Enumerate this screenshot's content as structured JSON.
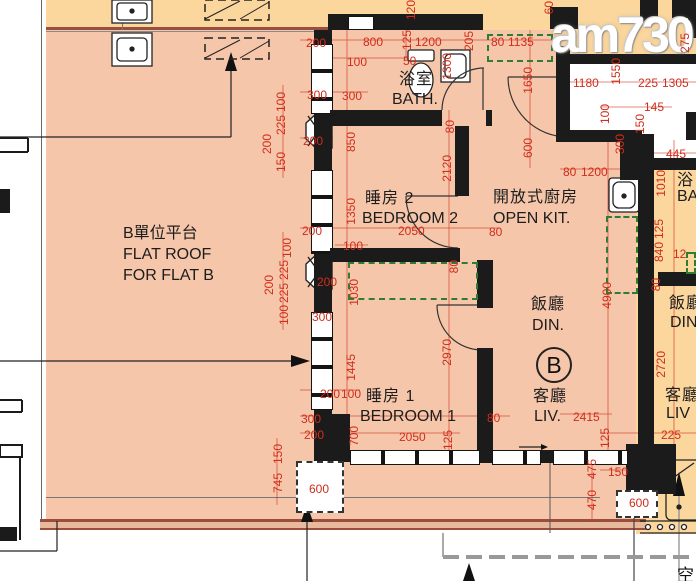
{
  "watermark": {
    "text": "am730"
  },
  "unit_badge": "B",
  "corner_label": "空",
  "colors": {
    "floor_pink": "#f6c6aa",
    "floor_orange": "#fbd79e",
    "dimension_red": "#d02d1c",
    "wall_black": "#1b1b1b",
    "cabinet_green": "#2e7d32",
    "parapet_maroon": "#9a4f3e"
  },
  "rooms": {
    "bath": {
      "zh": "浴室",
      "en": "BATH."
    },
    "bedroom2": {
      "zh": "睡房 2",
      "en": "BEDROOM 2"
    },
    "open_kitchen": {
      "zh": "開放式廚房",
      "en": "OPEN KIT."
    },
    "dining": {
      "zh": "飯廳",
      "en": "DIN."
    },
    "living": {
      "zh": "客廳",
      "en": "LIV."
    },
    "bedroom1": {
      "zh": "睡房 1",
      "en": "BEDROOM 1"
    },
    "flat_roof": {
      "zh": "B單位平台",
      "en_line1": "FLAT ROOF",
      "en_line2": "FOR FLAT B"
    }
  },
  "adjacent_unit": {
    "bath": {
      "zh": "浴",
      "en": "BA"
    },
    "dining": {
      "zh": "飯廳",
      "en": "DIN"
    },
    "living": {
      "zh": "客廳",
      "en": "LIV"
    }
  },
  "dimensions": [
    {
      "t": "200",
      "x": 306,
      "y": 37
    },
    {
      "t": "300",
      "x": 307,
      "y": 89
    },
    {
      "t": "100",
      "x": 275,
      "y": 92,
      "v": 1
    },
    {
      "t": "225",
      "x": 275,
      "y": 115,
      "v": 1
    },
    {
      "t": "200",
      "x": 261,
      "y": 134,
      "v": 1
    },
    {
      "t": "200",
      "x": 303,
      "y": 135
    },
    {
      "t": "150",
      "x": 275,
      "y": 152,
      "v": 1
    },
    {
      "t": "200",
      "x": 302,
      "y": 225
    },
    {
      "t": "100",
      "x": 281,
      "y": 238,
      "v": 1
    },
    {
      "t": "225",
      "x": 278,
      "y": 260,
      "v": 1
    },
    {
      "t": "200",
      "x": 263,
      "y": 275,
      "v": 1
    },
    {
      "t": "225",
      "x": 278,
      "y": 283,
      "v": 1
    },
    {
      "t": "100",
      "x": 278,
      "y": 305,
      "v": 1
    },
    {
      "t": "200",
      "x": 317,
      "y": 276
    },
    {
      "t": "300",
      "x": 312,
      "y": 311
    },
    {
      "t": "150",
      "x": 272,
      "y": 444,
      "v": 1
    },
    {
      "t": "745",
      "x": 272,
      "y": 473,
      "v": 1
    },
    {
      "t": "300",
      "x": 301,
      "y": 413
    },
    {
      "t": "200",
      "x": 304,
      "y": 429
    },
    {
      "t": "200",
      "x": 320,
      "y": 388
    },
    {
      "t": "100",
      "x": 341,
      "y": 388
    },
    {
      "t": "120",
      "x": 405,
      "y": 0,
      "v": 1
    },
    {
      "t": "800",
      "x": 363,
      "y": 36
    },
    {
      "t": "125",
      "x": 401,
      "y": 30,
      "v": 1
    },
    {
      "t": "1200",
      "x": 415,
      "y": 36
    },
    {
      "t": "205",
      "x": 463,
      "y": 31,
      "v": 1
    },
    {
      "t": "80",
      "x": 491,
      "y": 36
    },
    {
      "t": "1135",
      "x": 508,
      "y": 36
    },
    {
      "t": "100",
      "x": 347,
      "y": 56
    },
    {
      "t": "50",
      "x": 403,
      "y": 55
    },
    {
      "t": "300",
      "x": 342,
      "y": 90
    },
    {
      "t": "1300",
      "x": 441,
      "y": 53,
      "v": 1
    },
    {
      "t": "60",
      "x": 543,
      "y": 1,
      "v": 1
    },
    {
      "t": "1650",
      "x": 522,
      "y": 67,
      "v": 1
    },
    {
      "t": "600",
      "x": 522,
      "y": 138,
      "v": 1
    },
    {
      "t": "275",
      "x": 679,
      "y": 33,
      "v": 1
    },
    {
      "t": "1180",
      "x": 573,
      "y": 77
    },
    {
      "t": "1550",
      "x": 610,
      "y": 58,
      "v": 1
    },
    {
      "t": "225",
      "x": 638,
      "y": 77
    },
    {
      "t": "1305",
      "x": 662,
      "y": 77
    },
    {
      "t": "100",
      "x": 599,
      "y": 104,
      "v": 1
    },
    {
      "t": "145",
      "x": 644,
      "y": 101
    },
    {
      "t": "150",
      "x": 634,
      "y": 114,
      "v": 1
    },
    {
      "t": "300",
      "x": 614,
      "y": 134,
      "v": 1
    },
    {
      "t": "445",
      "x": 666,
      "y": 148
    },
    {
      "t": "1010",
      "x": 655,
      "y": 170,
      "v": 1
    },
    {
      "t": "80",
      "x": 563,
      "y": 166
    },
    {
      "t": "1200",
      "x": 581,
      "y": 166
    },
    {
      "t": "850",
      "x": 345,
      "y": 132,
      "v": 1
    },
    {
      "t": "80",
      "x": 444,
      "y": 120,
      "v": 1
    },
    {
      "t": "2120",
      "x": 441,
      "y": 155,
      "v": 1
    },
    {
      "t": "1350",
      "x": 345,
      "y": 198,
      "v": 1
    },
    {
      "t": "2050",
      "x": 398,
      "y": 225
    },
    {
      "t": "80",
      "x": 489,
      "y": 226
    },
    {
      "t": "100",
      "x": 343,
      "y": 240
    },
    {
      "t": "80",
      "x": 448,
      "y": 260,
      "v": 1
    },
    {
      "t": "1030",
      "x": 348,
      "y": 279,
      "v": 1
    },
    {
      "t": "4900",
      "x": 601,
      "y": 282,
      "v": 1
    },
    {
      "t": "125",
      "x": 653,
      "y": 219,
      "v": 1
    },
    {
      "t": "840",
      "x": 653,
      "y": 242,
      "v": 1
    },
    {
      "t": "80",
      "x": 650,
      "y": 278,
      "v": 1
    },
    {
      "t": "12",
      "x": 673,
      "y": 248
    },
    {
      "t": "2970",
      "x": 441,
      "y": 339,
      "v": 1
    },
    {
      "t": "1445",
      "x": 345,
      "y": 354,
      "v": 1
    },
    {
      "t": "700",
      "x": 348,
      "y": 426,
      "v": 1
    },
    {
      "t": "2050",
      "x": 399,
      "y": 431
    },
    {
      "t": "125",
      "x": 442,
      "y": 430,
      "v": 1
    },
    {
      "t": "80",
      "x": 487,
      "y": 412
    },
    {
      "t": "600",
      "x": 309,
      "y": 483
    },
    {
      "t": "2415",
      "x": 573,
      "y": 411
    },
    {
      "t": "125",
      "x": 599,
      "y": 428,
      "v": 1
    },
    {
      "t": "475",
      "x": 586,
      "y": 459,
      "v": 1
    },
    {
      "t": "470",
      "x": 586,
      "y": 490,
      "v": 1
    },
    {
      "t": "150",
      "x": 608,
      "y": 466
    },
    {
      "t": "600",
      "x": 629,
      "y": 497
    },
    {
      "t": "225",
      "x": 661,
      "y": 429
    },
    {
      "t": "2720",
      "x": 655,
      "y": 351,
      "v": 1
    }
  ]
}
